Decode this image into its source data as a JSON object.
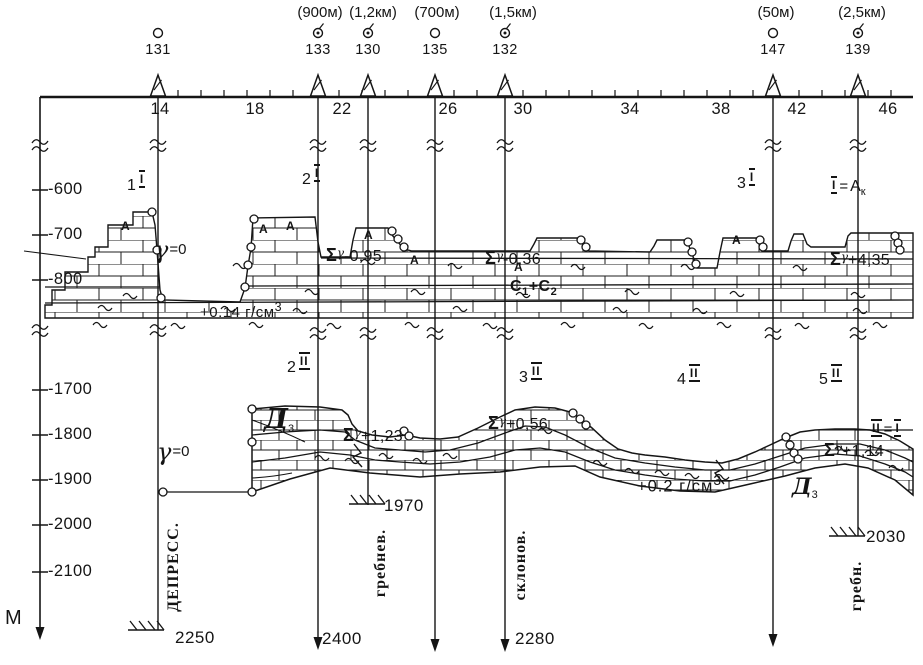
{
  "figure": {
    "bg": "#ffffff",
    "ink": "#151515"
  },
  "axis": {
    "unit": "М",
    "ticks": [
      {
        "label": "-600",
        "y": 190
      },
      {
        "label": "-700",
        "y": 235
      },
      {
        "label": "-800",
        "y": 280
      },
      {
        "label": "-1700",
        "y": 390
      },
      {
        "label": "-1800",
        "y": 435
      },
      {
        "label": "-1900",
        "y": 480
      },
      {
        "label": "-2000",
        "y": 525
      },
      {
        "label": "-2100",
        "y": 572
      }
    ]
  },
  "scale": {
    "ticks": [
      {
        "label": "14",
        "x": 160
      },
      {
        "label": "18",
        "x": 255
      },
      {
        "label": "22",
        "x": 342
      },
      {
        "label": "26",
        "x": 448
      },
      {
        "label": "30",
        "x": 523
      },
      {
        "label": "34",
        "x": 630
      },
      {
        "label": "38",
        "x": 721
      },
      {
        "label": "42",
        "x": 797
      },
      {
        "label": "46",
        "x": 888
      }
    ]
  },
  "wells": [
    {
      "id": "131",
      "x": 158,
      "symbol": "plain",
      "depth": "2250",
      "category": "ДЕПРЕСС."
    },
    {
      "id": "133",
      "x": 318,
      "symbol": "marked",
      "depth": "2400",
      "category": ""
    },
    {
      "id": "130",
      "x": 368,
      "symbol": "marked",
      "depth": "1970",
      "category": "гребнев."
    },
    {
      "id": "135",
      "x": 435,
      "symbol": "plain",
      "depth": "",
      "category": ""
    },
    {
      "id": "132",
      "x": 505,
      "symbol": "marked",
      "depth": "2280",
      "category": "склонов."
    },
    {
      "id": "147",
      "x": 773,
      "symbol": "plain",
      "depth": "",
      "category": ""
    },
    {
      "id": "139",
      "x": 858,
      "symbol": "marked",
      "depth": "2030",
      "category": "гребн."
    }
  ],
  "well_offsets": [
    {
      "label": "(900м)",
      "x": 320
    },
    {
      "label": "(1,2км)",
      "x": 373
    },
    {
      "label": "(700м)",
      "x": 437
    },
    {
      "label": "(1,5км)",
      "x": 513
    },
    {
      "label": "(50м)",
      "x": 776
    },
    {
      "label": "(2,5км)",
      "x": 862
    }
  ],
  "sections": {
    "upper": {
      "profiles": [
        {
          "n": "1",
          "roman": "I"
        },
        {
          "n": "2",
          "roman": "I"
        },
        {
          "n": "3",
          "roman": "I"
        }
      ],
      "identity": {
        "left": "I",
        "eq": "=",
        "base": "А",
        "sub": "к"
      },
      "anomalies": [
        {
          "sigma": "Σ",
          "gamma": "γ",
          "value": "-0,95"
        },
        {
          "sigma": "Σ",
          "gamma": "γ",
          "value": "-0,36"
        },
        {
          "sigma": "Σ",
          "gamma": "γ",
          "value": "+4,35"
        }
      ],
      "formation": {
        "base1": "С",
        "sub1": "1",
        "plus": "+",
        "base2": "С",
        "sub2": "2"
      },
      "density": {
        "value": "+0.14",
        "unit": "г/см",
        "exp": "3"
      },
      "gamma_zero": {
        "gamma": "γ",
        "eq": "=0"
      },
      "a_marks": [
        {
          "label": "А",
          "x": 121,
          "y": 220
        },
        {
          "label": "А",
          "x": 259,
          "y": 223
        },
        {
          "label": "А",
          "x": 286,
          "y": 220
        },
        {
          "label": "А",
          "x": 364,
          "y": 229
        },
        {
          "label": "А",
          "x": 410,
          "y": 254
        },
        {
          "label": "А",
          "x": 514,
          "y": 261
        },
        {
          "label": "А",
          "x": 732,
          "y": 234
        }
      ]
    },
    "lower": {
      "profiles": [
        {
          "n": "2",
          "roman": "II"
        },
        {
          "n": "3",
          "roman": "II"
        },
        {
          "n": "4",
          "roman": "II"
        },
        {
          "n": "5",
          "roman": "II"
        }
      ],
      "identity": {
        "left": "II",
        "eq": "=",
        "right": "I"
      },
      "anomalies": [
        {
          "sigma": "Σ",
          "gamma": "γ",
          "value": "+1,23"
        },
        {
          "sigma": "Σ",
          "gamma": "γ",
          "value": "+0,56"
        },
        {
          "sigma": "Σ",
          "gamma": "γ",
          "value": "+1,14"
        }
      ],
      "formation": {
        "letter": "Д",
        "sub": "3"
      },
      "density": {
        "value": "+0.2",
        "unit": "г/см",
        "exp": "3"
      },
      "gamma_zero": {
        "gamma": "γ",
        "eq": "=0"
      }
    }
  }
}
